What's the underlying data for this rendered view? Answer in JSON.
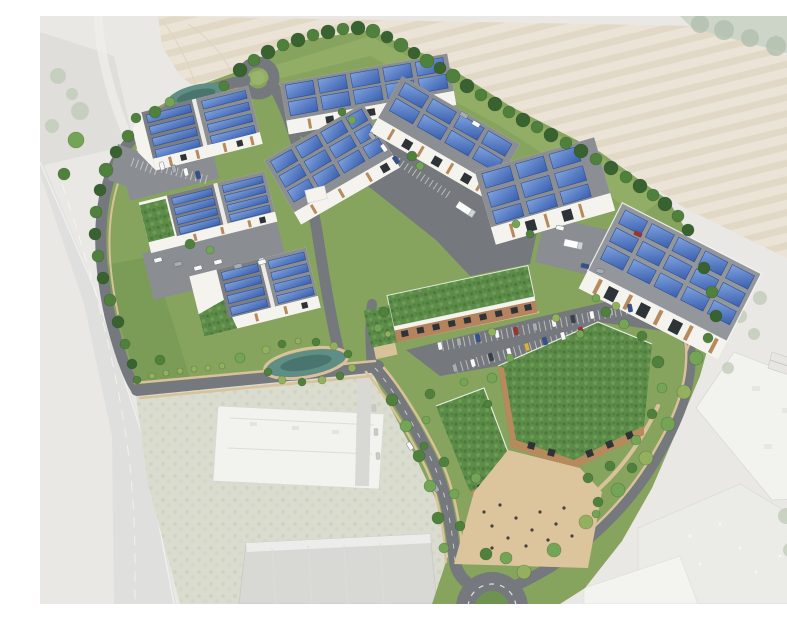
{
  "scene": {
    "type": "architectural-aerial-render",
    "description": "Computer-generated aerial visualisation of a proposed business park: white industrial units with blue solar-panelled roofs, a green-roofed terrace of smaller units, two timber-clad offices with large green roofs, landscaped grounds, ponds, parking courts and a roundabout, all set within a faded aerial photograph of the surrounding area (ploughed field to the north-east, dual carriageway to the west, existing industrial buildings to the south)",
    "site": {
      "industrial_units_with_solar_roofs": 8,
      "green_roof_buildings": 3,
      "green_roof_wedges": 2,
      "ponds": 2,
      "turning_circle": 1,
      "roundabout": 1,
      "trucks": 2,
      "parking_areas": 6,
      "pedestrian_plaza": 1
    },
    "surroundings": {
      "north_east": "ploughed field",
      "west": "dual carriageway (faded)",
      "south": "existing industrial buildings (faded)",
      "south_east": "existing industrial estate (faded)"
    }
  },
  "palette": {
    "field": "#eae3d6",
    "field_stripe": "#e0d5c2",
    "context": "#e9e8e4",
    "context_dark": "#dadad6",
    "highway": "#dfdfdd",
    "scrub": "#d9dccf",
    "grass": "#86a45e",
    "grass_light": "#9ab46e",
    "grass_dark": "#6e9350",
    "road": "#75787c",
    "road_light": "#8a8d91",
    "sidewalk": "#d9c19a",
    "roof": "#8b8f93",
    "roof_dark": "#7b7f83",
    "roof_flat": "#93979b",
    "wall": "#f4f3ee",
    "timber": "#b68a5c",
    "brick": "#b5835e",
    "solar": "#4a74c0",
    "solar_dark": "#2d4f94",
    "green_roof": "#5d8c49",
    "tree_dark": "#38622f",
    "tree_mid": "#4f813c",
    "tree_light": "#74a455",
    "tree_pale": "#94b05e",
    "faded_tree": "#bfc9b8",
    "pond": "#5f8e86",
    "pond_dark": "#49756e",
    "plaza": "#dcc49c",
    "car_white": "#f8f8f8",
    "car_gray": "#a7adb3",
    "car_blue": "#33518e",
    "car_red": "#a33128",
    "car_yellow": "#d9b23c",
    "car_dark": "#3a4046",
    "person": "#46413a"
  }
}
